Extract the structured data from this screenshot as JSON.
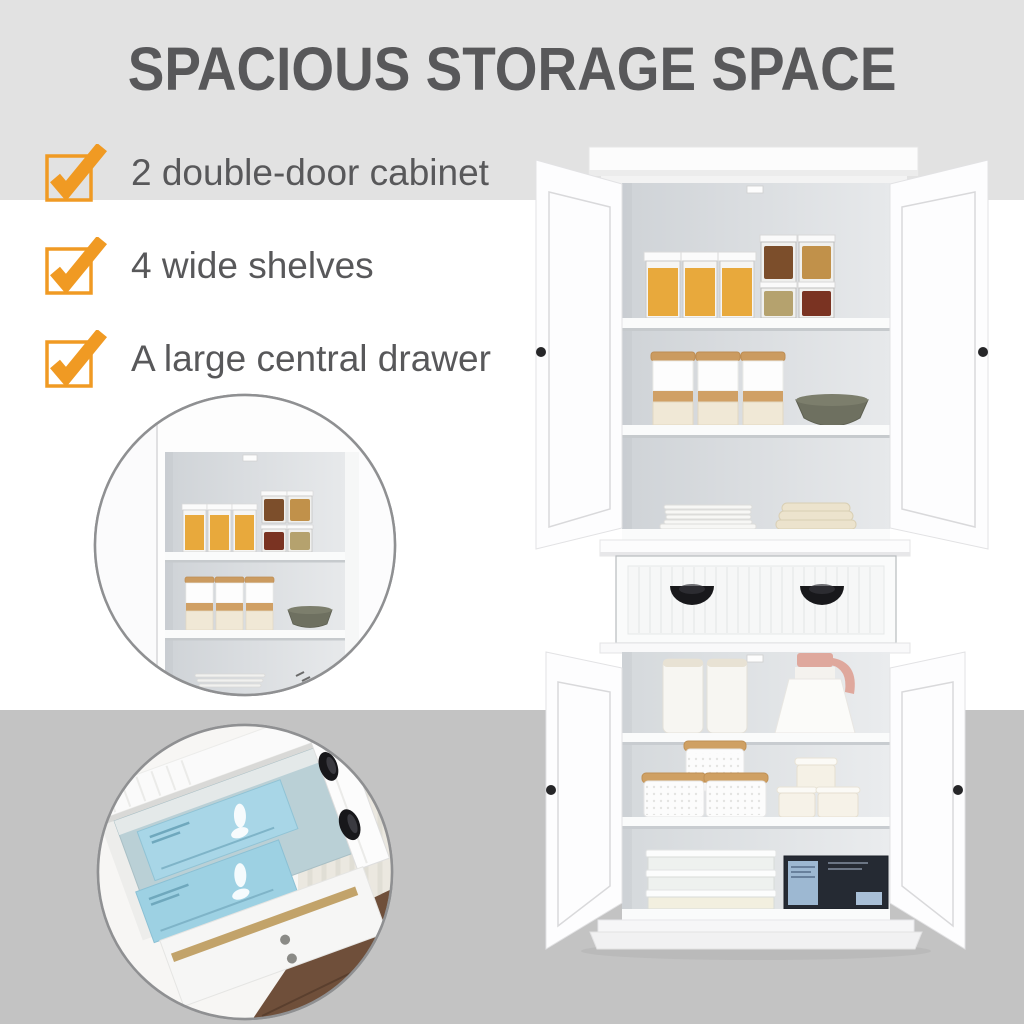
{
  "title": {
    "text": "SPACIOUS STORAGE SPACE"
  },
  "features": {
    "items": [
      {
        "label": "2 double-door cabinet"
      },
      {
        "label": "4 wide shelves"
      },
      {
        "label": "A large central drawer"
      }
    ]
  },
  "colors": {
    "accent": "#F09A23",
    "heading_text": "#58585A",
    "body_text": "#58585A",
    "top_band": "#E2E2E2",
    "bottom_band": "#C3C3C3"
  },
  "media": {
    "main_photo": "white-pantry-cabinet-open-doors",
    "inset_top": "upper-shelves-closeup",
    "inset_bottom": "open-central-drawer-closeup"
  }
}
